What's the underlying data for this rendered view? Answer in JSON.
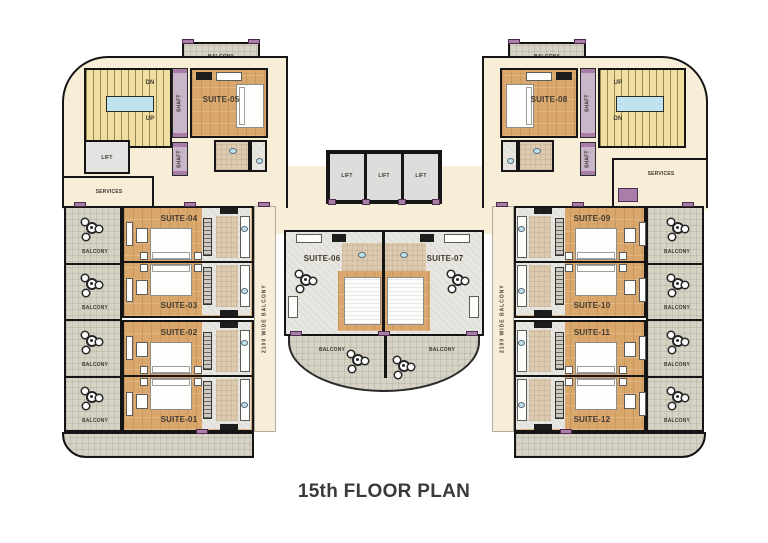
{
  "title": "15th FLOOR PLAN",
  "labels": {
    "balcony": "BALCONY",
    "lift": "LIFT",
    "shaft": "SHAFT",
    "services": "SERVICES",
    "up": "UP",
    "dn": "DN",
    "wide_balcony": "2100 WIDE BALCONY"
  },
  "suites": [
    {
      "label": "SUITE-01"
    },
    {
      "label": "SUITE-02"
    },
    {
      "label": "SUITE-03"
    },
    {
      "label": "SUITE-04"
    },
    {
      "label": "SUITE-05"
    },
    {
      "label": "SUITE-06"
    },
    {
      "label": "SUITE-07"
    },
    {
      "label": "SUITE-08"
    },
    {
      "label": "SUITE-09"
    },
    {
      "label": "SUITE-10"
    },
    {
      "label": "SUITE-11"
    },
    {
      "label": "SUITE-12"
    }
  ],
  "colors": {
    "floor_cream": "#f8edd7",
    "wood_floor": "#d9a76c",
    "balcony_tile": "#d7d3c4",
    "bath_tile": "#e8e6e0",
    "bath_tan": "#dcc9ae",
    "stair_yellow": "#f0dfa0",
    "wall_black": "#151515",
    "accent_mauve": "#a87ea8",
    "landing_blue": "#bfe4ef",
    "title_text": "#3a3a3a"
  }
}
